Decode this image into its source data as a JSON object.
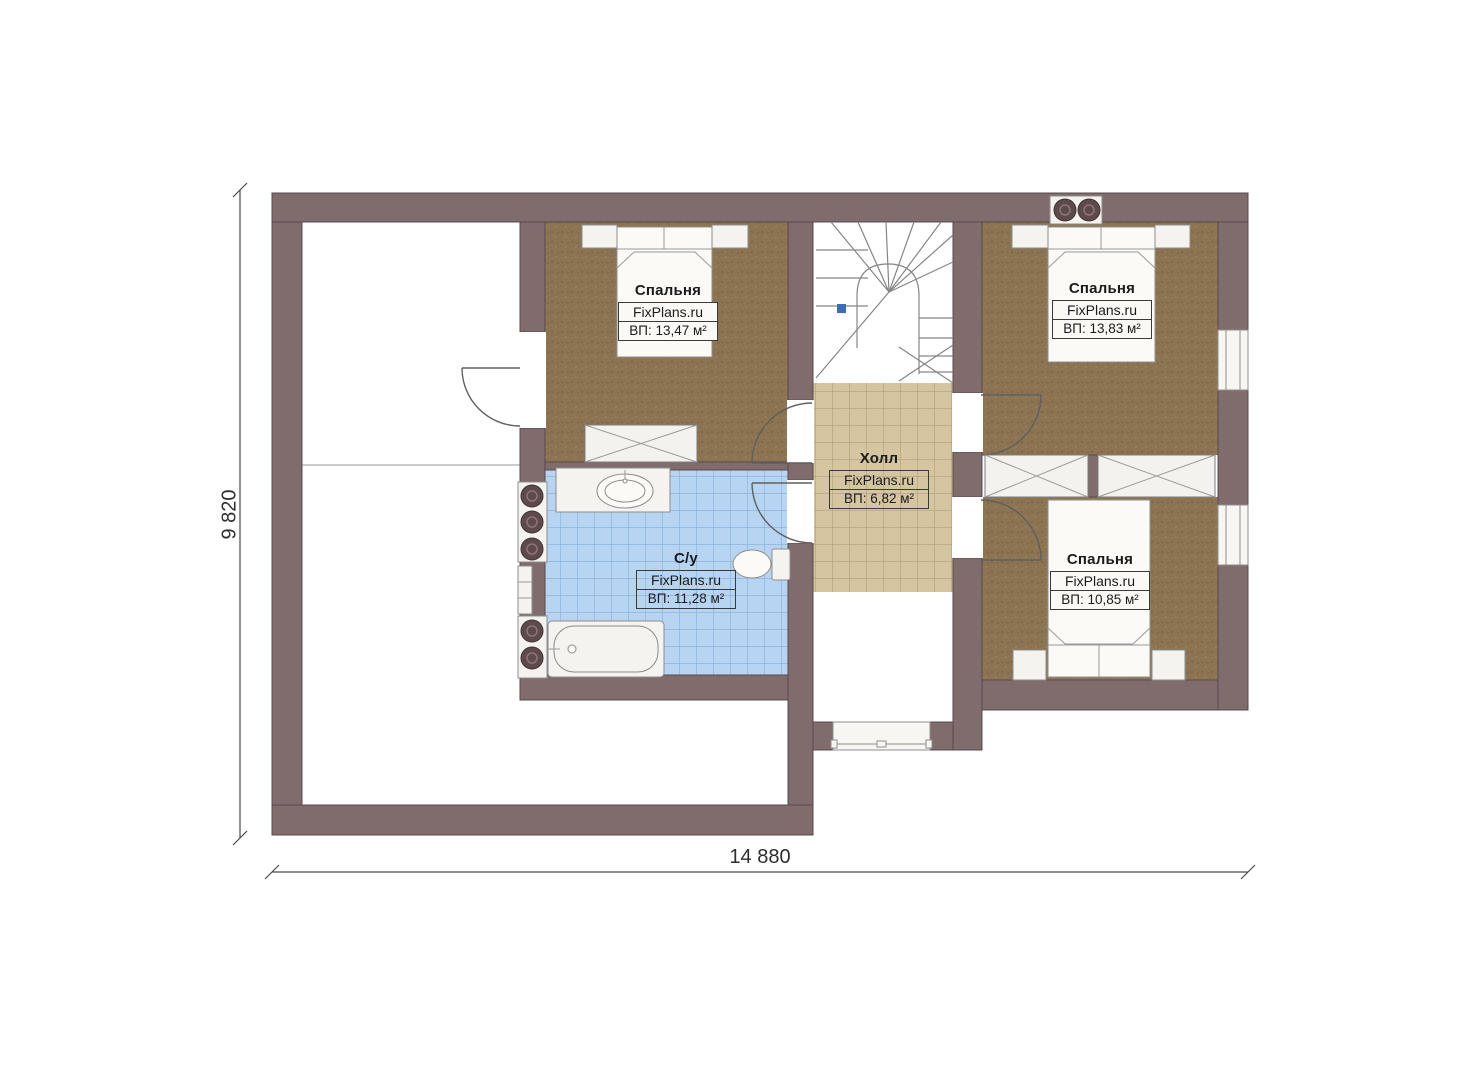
{
  "brand": "FixPlans.ru",
  "dimensions": {
    "height_label": "9 820",
    "width_label": "14 880"
  },
  "rooms": [
    {
      "key": "bedroom-1",
      "name": "Спальня",
      "brand": "FixPlans.ru",
      "area": "ВП: 13,47 м²"
    },
    {
      "key": "bedroom-2",
      "name": "Спальня",
      "brand": "FixPlans.ru",
      "area": "ВП: 13,83 м²"
    },
    {
      "key": "bedroom-3",
      "name": "Спальня",
      "brand": "FixPlans.ru",
      "area": "ВП: 10,85 м²"
    },
    {
      "key": "bathroom",
      "name": "С/у",
      "brand": "FixPlans.ru",
      "area": "ВП: 11,28 м²"
    },
    {
      "key": "hall",
      "name": "Холл",
      "brand": "FixPlans.ru",
      "area": "ВП: 6,82 м²"
    }
  ],
  "colors": {
    "wall": "#806b6d",
    "wall_outline": "#594a4c",
    "wood_floor": "#8c7452",
    "bathroom_tile": "#b7d5f2",
    "bathroom_tile_line": "#86aed6",
    "hall_tile": "#d5c5a1",
    "hall_tile_line": "#b3a079",
    "marker_blue": "#3d6db5"
  }
}
